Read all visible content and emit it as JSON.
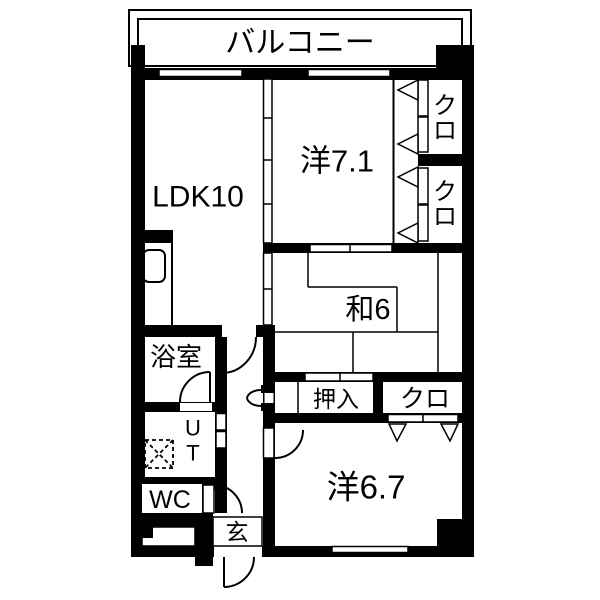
{
  "labels": {
    "balcony": "バルコニー",
    "ldk": "LDK10",
    "western_7_1": "洋7.1",
    "japanese_6": "和6",
    "western_6_7": "洋6.7",
    "bathroom": "浴室",
    "oshiire": "押入",
    "closet_south": "クロ",
    "closet1_top": "ク",
    "closet1_bottom": "ロ",
    "closet2_top": "ク",
    "closet2_bottom": "ロ",
    "ut_top": "U",
    "ut_bottom": "T",
    "wc": "WC",
    "entrance": "玄"
  },
  "colors": {
    "wall": "#000000",
    "floor": "#ffffff"
  }
}
